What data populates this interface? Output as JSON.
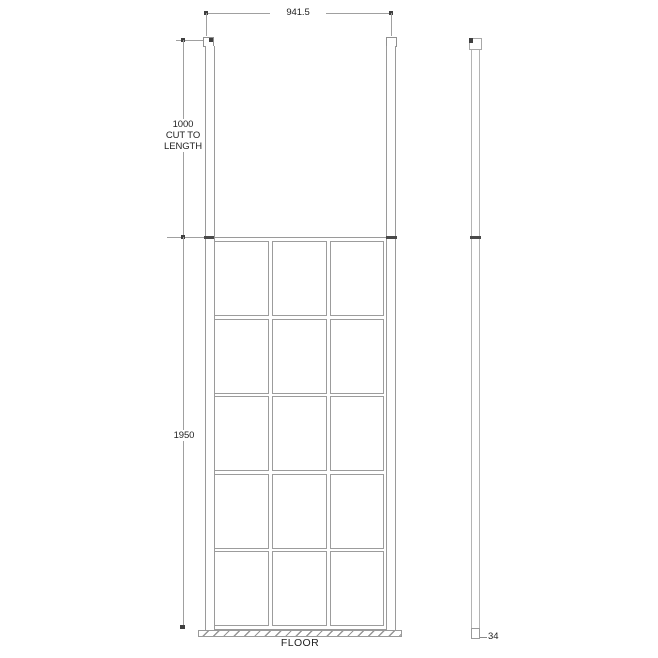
{
  "colors": {
    "background": "#ffffff",
    "line": "#9a9a9a",
    "line_light": "#b4b4b4",
    "tick_dark": "#3f3f3f",
    "text": "#1f1f1f"
  },
  "labels": {
    "width": "941.5",
    "post_height_line1": "1000",
    "post_height_line2": "CUT TO",
    "post_height_line3": "LENGTH",
    "screen_height": "1950",
    "floor": "FLOOR",
    "profile_depth": "34"
  },
  "front_view": {
    "grid": {
      "columns": 3,
      "rows": 5
    }
  }
}
